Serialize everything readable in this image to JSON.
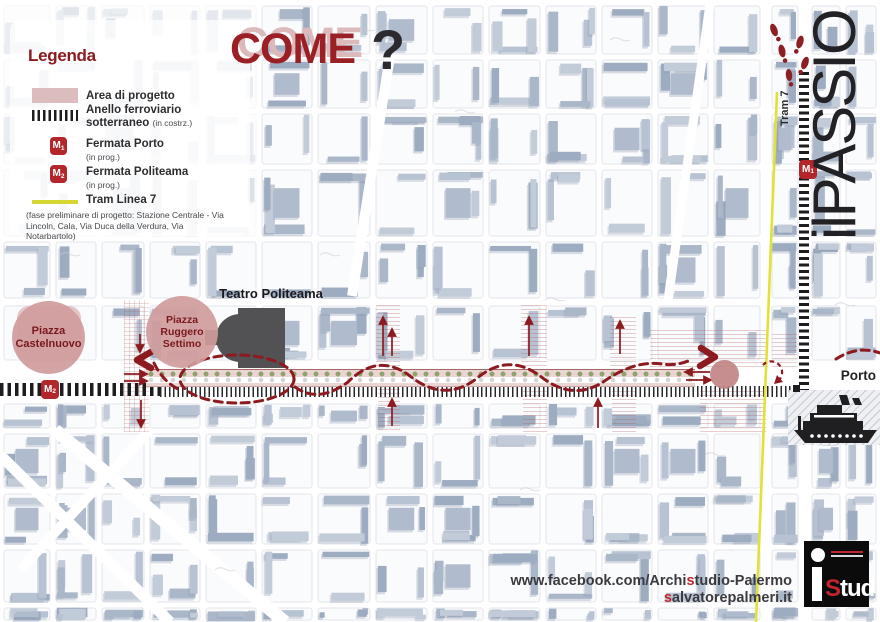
{
  "legend": {
    "title": "Legenda",
    "area": {
      "label": "Area di progetto"
    },
    "anello": {
      "label": "Anello ferroviario sotterraneo",
      "note": "(in costrz.)"
    },
    "m1": {
      "badge": "M",
      "sub": "1",
      "label": "Fermata Porto",
      "note": "(in prog.)"
    },
    "m2": {
      "badge": "M",
      "sub": "2",
      "label": "Fermata Politeama",
      "note": "(in prog.)"
    },
    "tram": {
      "label": "Tram Linea 7",
      "note": "(fase preliminare di progetto: Stazione Centrale - Via Lincoln, Cala, Via Duca della Verdura, Via Notarbartolo)"
    }
  },
  "title": {
    "word": "COME",
    "question_mark": "?"
  },
  "branding": {
    "logo_text": "ilPASSIO"
  },
  "map": {
    "tram_line_label": "Tram 7",
    "stops": {
      "m1": {
        "badge": "M",
        "sub": "1"
      },
      "m2": {
        "badge": "M",
        "sub": "2"
      }
    },
    "labels": {
      "teatro": "Teatro Politeama",
      "piazza_castelnuovo": "Piazza Castelnuovo",
      "piazza_ruggero": "Piazza Ruggero Settimo",
      "porto": "Porto"
    }
  },
  "footer": {
    "line1_pre": "www.facebook.com/Archi",
    "line1_red": "s",
    "line1_post": "tudio-Palermo",
    "line2_red": "s",
    "line2_post": "alvatorepalmeri.it"
  },
  "logo": {
    "s": "S",
    "tud": "tud"
  },
  "colors": {
    "brand_red": "#8c1b20",
    "title_red": "#9b2025",
    "title_shadow_pink": "#dcb9ba",
    "area_pink": "#dcbcbc",
    "band_pink": "#ead5d3",
    "dot_green": "#91a06f",
    "badge_red": "#b2262c",
    "tram_yellow": "#e2e236",
    "building_blue_gray": "#b3bfd0",
    "theater_gray": "#525254"
  }
}
